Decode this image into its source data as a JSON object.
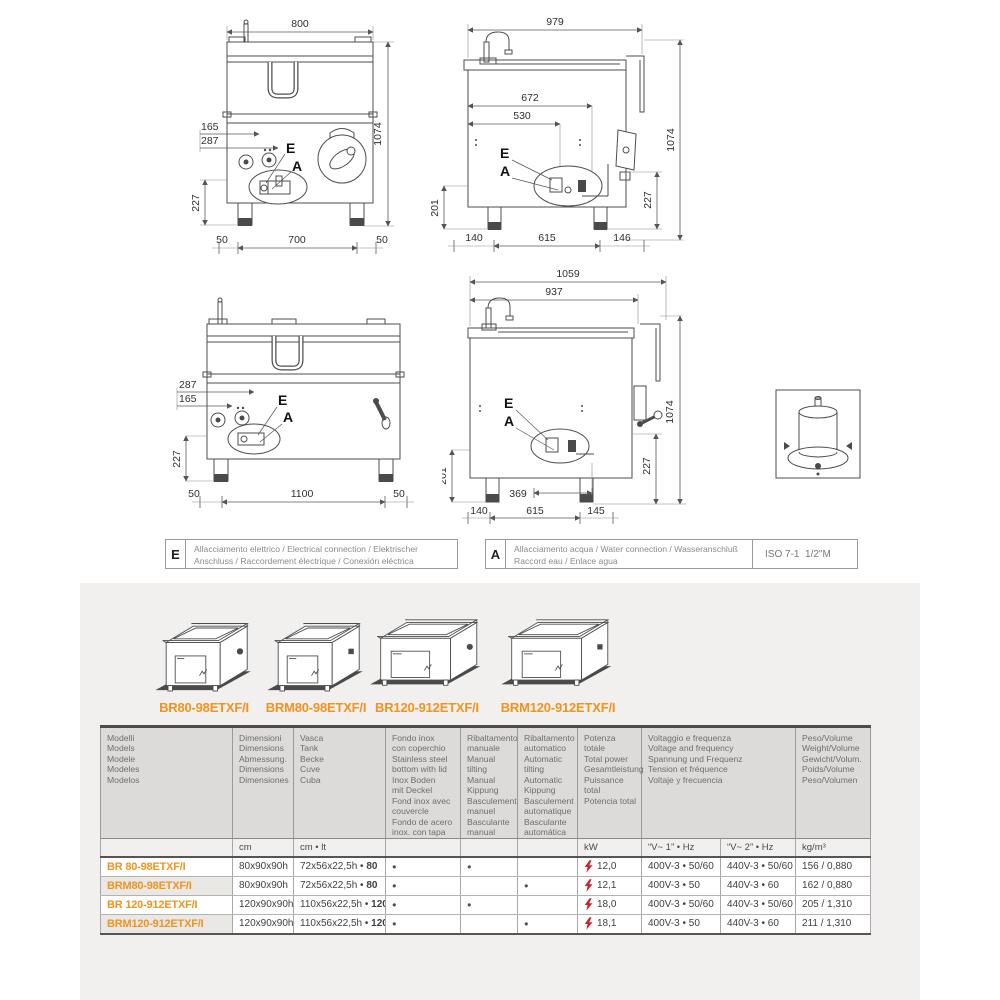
{
  "colors": {
    "accent_orange": "#f0931f",
    "bolt_red": "#cc2026",
    "panel_gray": "#f1f0ee"
  },
  "drawings": {
    "front_800": {
      "top": "800",
      "height": "1074",
      "left_a": "165",
      "left_b": "287",
      "left_v": "227",
      "bottom": [
        "50",
        "700",
        "50"
      ],
      "point_e": "E",
      "point_a": "A"
    },
    "side_979": {
      "top": "979",
      "height": "1074",
      "inner_a": "672",
      "inner_b": "530",
      "left_v": "201",
      "right_v": "227",
      "bottom": [
        "140",
        "615",
        "146"
      ],
      "point_e": "E",
      "point_a": "A"
    },
    "front_1200": {
      "left_a": "287",
      "left_b": "165",
      "left_v": "227",
      "bottom": [
        "50",
        "1100",
        "50"
      ],
      "point_e": "E",
      "point_a": "A"
    },
    "side_1059": {
      "top": "1059",
      "top_b": "937",
      "height": "1074",
      "left_v": "201",
      "right_v": "227",
      "inner": "369",
      "bottom": [
        "140",
        "615",
        "145"
      ],
      "point_e": "E",
      "point_a": "A"
    }
  },
  "legend": {
    "electrical": {
      "symbol": "E",
      "text": "Allacciamento elettrico / Electrical connection / Elektrischer\nAnschluss / Raccordement électrique / Conexión eléctrica"
    },
    "water": {
      "symbol": "A",
      "text": "Allacciamento acqua / Water connection / Wasseranschluß\nRaccord eau / Enlace agua",
      "spec": "ISO 7-1  1/2\"M"
    }
  },
  "products": [
    {
      "name": "BR80-98ETXF/I"
    },
    {
      "name": "BRM80-98ETXF/I"
    },
    {
      "name": "BR120-912ETXF/I"
    },
    {
      "name": "BRM120-912ETXF/I"
    }
  ],
  "table": {
    "headers": [
      "Modelli\nModels\nModele\nModeles\nModelos",
      "Dimensioni\nDimensions\nAbmessung.\nDimensions\nDimensiones",
      "Vasca\nTank\nBecke\nCuve\nCuba",
      "Fondo inox\ncon coperchio\nStainless steel\nbottom with lid\nInox Boden\nmit Deckel\nFond inox avec\ncouvercle\nFondo de acero\ninox. con tapa",
      "Ribaltamento\nmanuale\nManual\ntilting\nManual\nKippung\nBasculement\nmanuel\nBasculante\nmanual",
      "Ribaltamento\nautomatico\nAutomatic\ntilting\nAutomatic\nKippung\nBasculement\nautomatique\nBasculante\nautomática",
      "Potenza totale\nTotal power\nGesamtleistung\nPuissance total\nPotencia total",
      "Voltaggio e frequenza\nVoltage and frequency\nSpannung und Frequenz\nTension et fréquence\nVoltaje y frecuencia",
      "Peso/Volume\nWeight/Volume\nGewicht/Volum.\nPoids/Volume\nPeso/Volumen"
    ],
    "units": [
      "",
      "cm",
      "cm • lt",
      "",
      "",
      "",
      "kW",
      "“V~ 1” • Hz",
      "“V~ 2” • Hz",
      "kg/m³"
    ],
    "rows": [
      {
        "model": "BR 80-98ETXF/I",
        "dim": "80x90x90h",
        "tank": "72x56x22,5h •",
        "tank_cap": "80",
        "lid": "●",
        "manual": "●",
        "auto": "",
        "power": "12,0",
        "v1": "400V-3 • 50/60",
        "v2": "440V-3 • 50/60",
        "weight": "156 / 0,880"
      },
      {
        "model": "BRM80-98ETXF/I",
        "dim": "80x90x90h",
        "tank": "72x56x22,5h •",
        "tank_cap": "80",
        "lid": "●",
        "manual": "",
        "auto": "●",
        "power": "12,1",
        "v1": "400V-3 • 50",
        "v2": "440V-3 • 60",
        "weight": "162 / 0,880"
      },
      {
        "model": "BR 120-912ETXF/I",
        "dim": "120x90x90h",
        "tank": "110x56x22,5h •",
        "tank_cap": "120",
        "lid": "●",
        "manual": "●",
        "auto": "",
        "power": "18,0",
        "v1": "400V-3 • 50/60",
        "v2": "440V-3 • 50/60",
        "weight": "205 / 1,310"
      },
      {
        "model": "BRM120-912ETXF/I",
        "dim": "120x90x90h",
        "tank": "110x56x22,5h •",
        "tank_cap": "120",
        "lid": "●",
        "manual": "",
        "auto": "●",
        "power": "18,1",
        "v1": "400V-3 • 50",
        "v2": "440V-3 • 60",
        "weight": "211 / 1,310"
      }
    ]
  }
}
